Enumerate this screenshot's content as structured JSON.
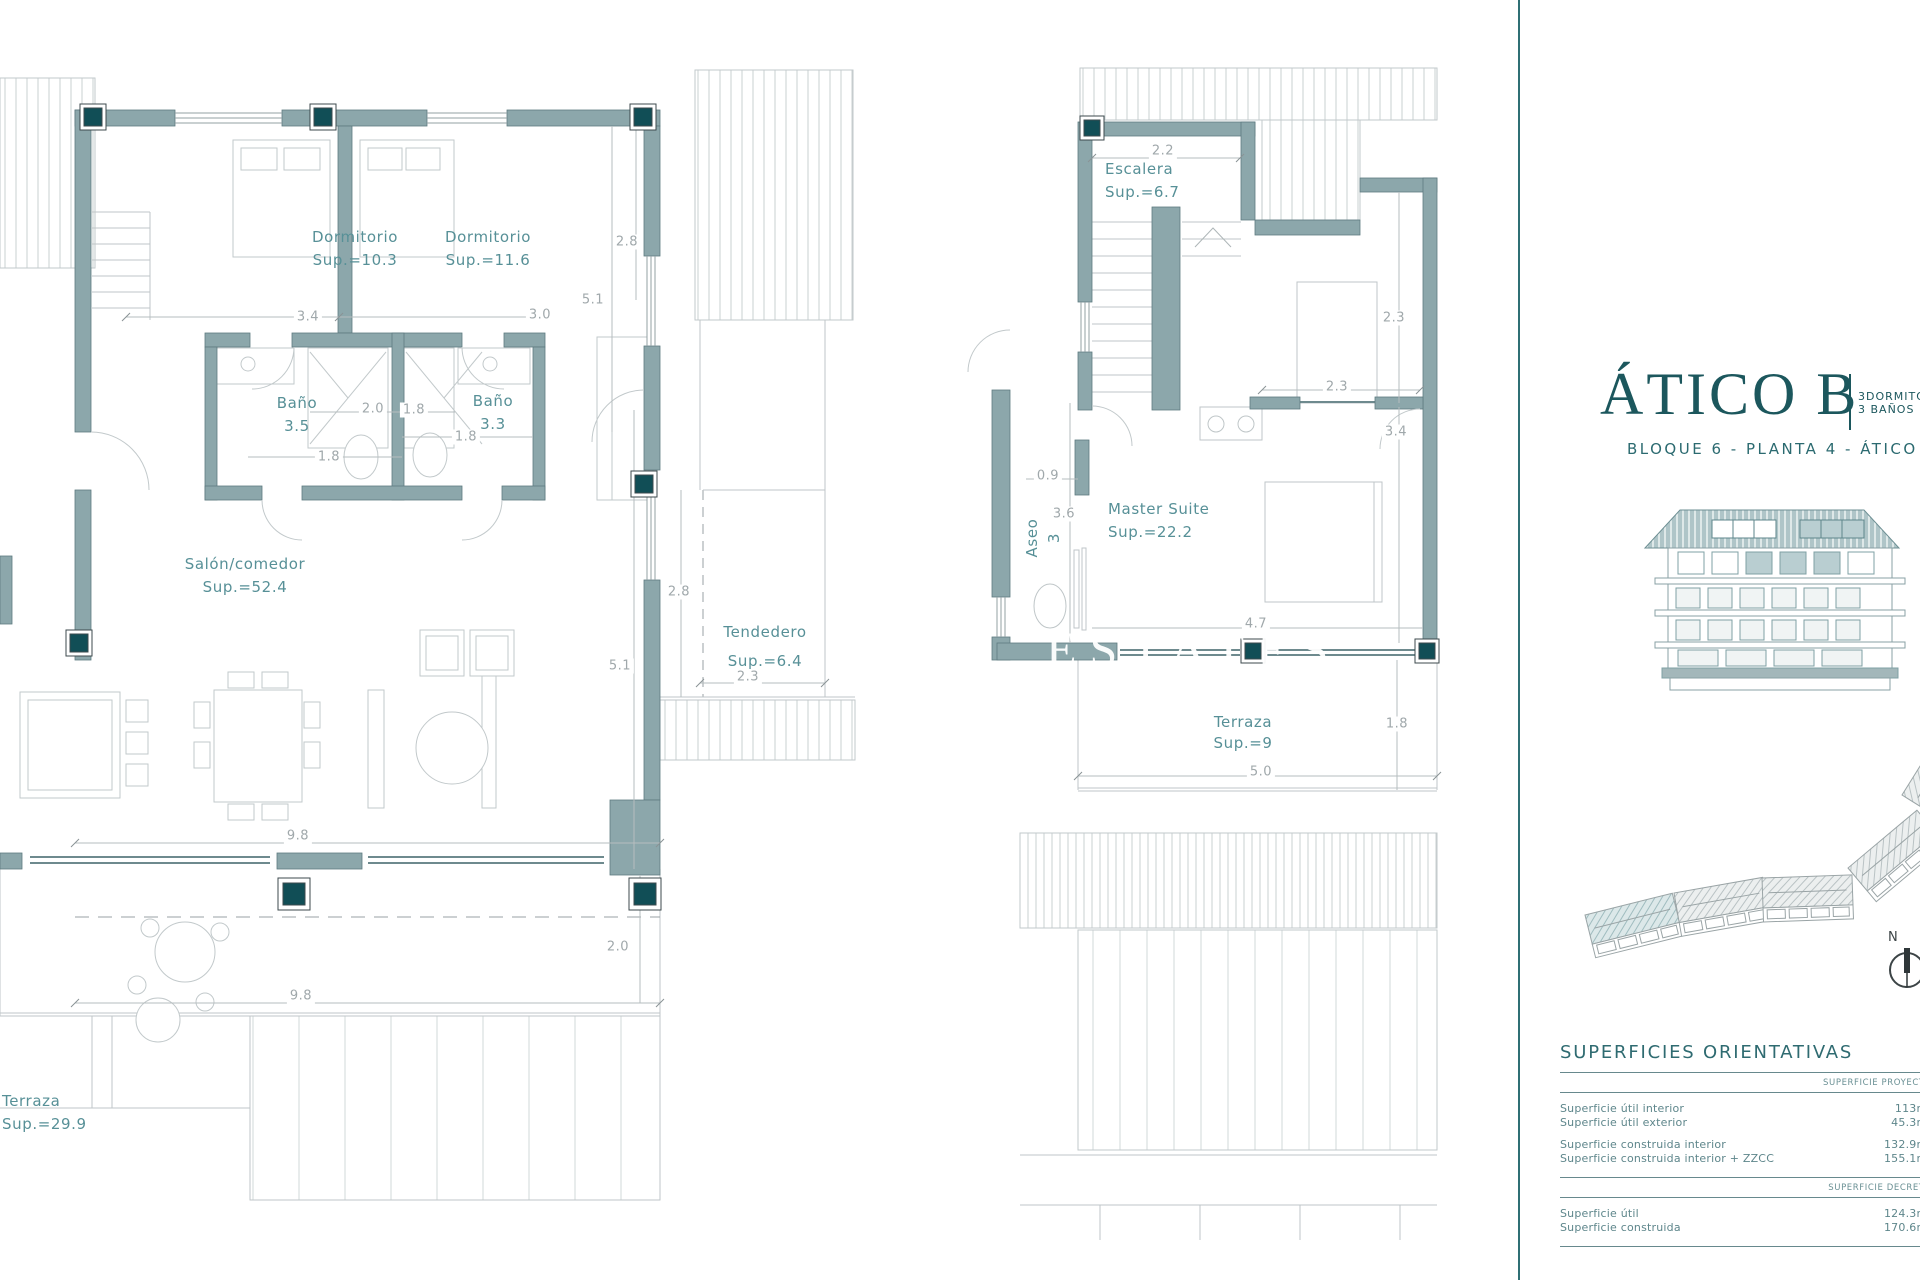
{
  "colors": {
    "wall": "#8CA7AB",
    "wall_edge": "#5E7B80",
    "column_dark": "#114E56",
    "thin_line": "#BCC3C5",
    "dim_text": "#A0A8AB",
    "room_text": "#579097",
    "accent_teal": "#2F6F74",
    "title_teal": "#1C575D"
  },
  "plan1": {
    "rooms": {
      "dorm1": {
        "name": "Dormitorio",
        "sup": "Sup.=10.3"
      },
      "dorm2": {
        "name": "Dormitorio",
        "sup": "Sup.=11.6"
      },
      "bath1": {
        "name": "Baño",
        "sup": "3.5"
      },
      "bath2": {
        "name": "Baño",
        "sup": "3.3"
      },
      "salon": {
        "name": "Salón/comedor",
        "sup": "Sup.=52.4"
      },
      "tendedero": {
        "name": "Tendedero",
        "sup": "Sup.=6.4"
      },
      "terraza": {
        "name": "Terraza",
        "sup": "Sup.=29.9"
      }
    },
    "dims": {
      "d1": "3.4",
      "d2": "3.0",
      "d3": "2.8",
      "d4": "5.1",
      "d5": "2.0",
      "d6": "1.8",
      "d7": "1.8",
      "d8": "1.8",
      "d9": "2.8",
      "d10": "5.1",
      "d11": "2.3",
      "d12": "9.8",
      "d13": "2.0",
      "d14": "9.8"
    }
  },
  "plan2": {
    "rooms": {
      "escalera": {
        "name": "Escalera",
        "sup": "Sup.=6.7"
      },
      "aseo": {
        "name": "Aseo",
        "sup": "3"
      },
      "master": {
        "name": "Master Suite",
        "sup": "Sup.=22.2"
      },
      "terraza": {
        "name": "Terraza",
        "sup": "Sup.=9"
      }
    },
    "dims": {
      "d1": "2.2",
      "d2": "2.3",
      "d3": "2.3",
      "d4": "0.9",
      "d5": "3.6",
      "d6": "3.4",
      "d7": "4.7",
      "d8": "5.0",
      "d9": "1.8"
    }
  },
  "info": {
    "title": "ÁTICO B",
    "bedrooms": "3DORMITORIOS",
    "bathrooms": "3 BAÑOS",
    "subtitle": "BLOQUE 6 - PLANTA 4 - ÁTICO B",
    "north": "N"
  },
  "table": {
    "title": "SUPERFICIES ORIENTATIVAS",
    "header1": "SUPERFICIE PROYECTO",
    "rows1": [
      {
        "label": "Superficie útil interior",
        "value": "113m²"
      },
      {
        "label": "Superficie útil exterior",
        "value": "45.3m²"
      },
      {
        "label": "Superficie construida interior",
        "value": "132.9m²"
      },
      {
        "label": "Superficie construida interior + ZZCC",
        "value": "155.1m²"
      }
    ],
    "header2": "SUPERFICIE DECRETO",
    "rows2": [
      {
        "label": "Superficie útil",
        "value": "124.3m²"
      },
      {
        "label": "Superficie construida",
        "value": "170.6m²"
      }
    ]
  },
  "watermark": "ESTATES"
}
